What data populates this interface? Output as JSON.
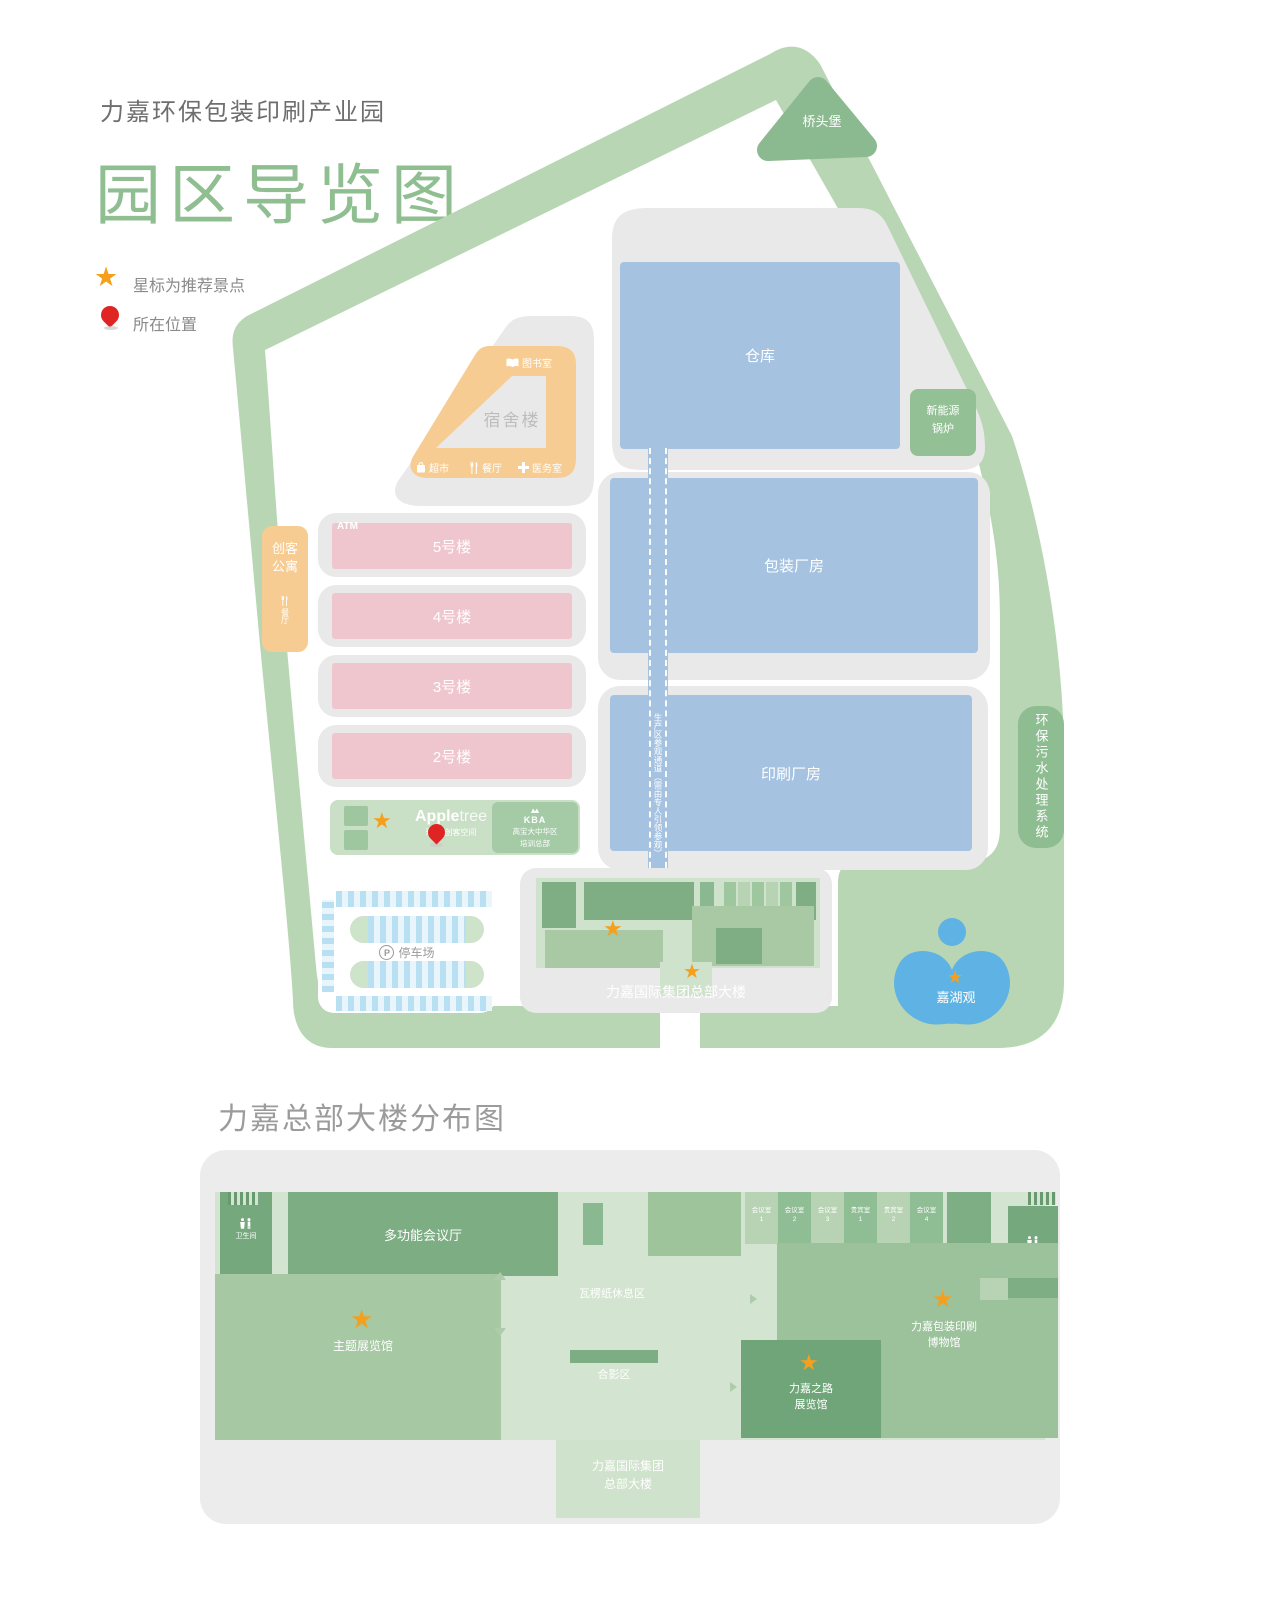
{
  "header": {
    "park_name": "力嘉环保包装印刷产业园",
    "map_title": "园区导览图",
    "legend_star": "星标为推荐景点",
    "legend_pin": "所在位置"
  },
  "map": {
    "bridgehead": "桥头堡",
    "warehouse": "仓库",
    "boiler_line1": "新能源",
    "boiler_line2": "锅炉",
    "packaging_plant": "包装厂房",
    "printing_plant": "印刷厂房",
    "corridor_note": "生产区参观通道（需由专人引领参观）",
    "dorm": {
      "label": "宿舍楼",
      "library": "图书室",
      "market": "超市",
      "canteen": "餐厅",
      "clinic": "医务室"
    },
    "maker_apartment_line1": "创客",
    "maker_apartment_line2": "公寓",
    "maker_canteen": "餐厅",
    "atm": "ATM",
    "building5": "5号楼",
    "building4": "4号楼",
    "building3": "3号楼",
    "building2": "2号楼",
    "appletree": {
      "brand_bold": "Apple",
      "brand_light": "tree",
      "subtitle": "环保·创客空间"
    },
    "kba": {
      "name": "KBA",
      "line1": "高宝大中华区",
      "line2": "培训总部"
    },
    "parking_p": "P",
    "parking_label": "停车场",
    "hq_label": "力嘉国际集团总部大楼",
    "lake": "嘉湖观",
    "sewage": "环保污水处理系统"
  },
  "floor_plan": {
    "title": "力嘉总部大楼分布图",
    "restroom": "卫生间",
    "multi_hall": "多功能会议厅",
    "rooms": [
      {
        "name": "会议室",
        "num": "1"
      },
      {
        "name": "会议室",
        "num": "2"
      },
      {
        "name": "会议室",
        "num": "3"
      },
      {
        "name": "贵宾室",
        "num": "1"
      },
      {
        "name": "贵宾室",
        "num": "2"
      },
      {
        "name": "会议室",
        "num": "4"
      }
    ],
    "rest_area": "瓦楞纸休息区",
    "photo_area": "合影区",
    "theme_hall": "主题展览馆",
    "museum_line1": "力嘉包装印刷",
    "museum_line2": "博物馆",
    "road_hall_line1": "力嘉之路",
    "road_hall_line2": "展览馆",
    "tower_line1": "力嘉国际集团",
    "tower_line2": "总部大楼"
  },
  "colors": {
    "band_green": "#b8d6b4",
    "dark_green": "#8cba90",
    "building_blue": "#a5c2e1",
    "building_pink": "#f0c6ce",
    "orange": "#f7cc92",
    "star": "#f5a01d",
    "pin_red": "#e02424",
    "lake_blue": "#5fb2e4",
    "title_green": "#8fbe91"
  }
}
